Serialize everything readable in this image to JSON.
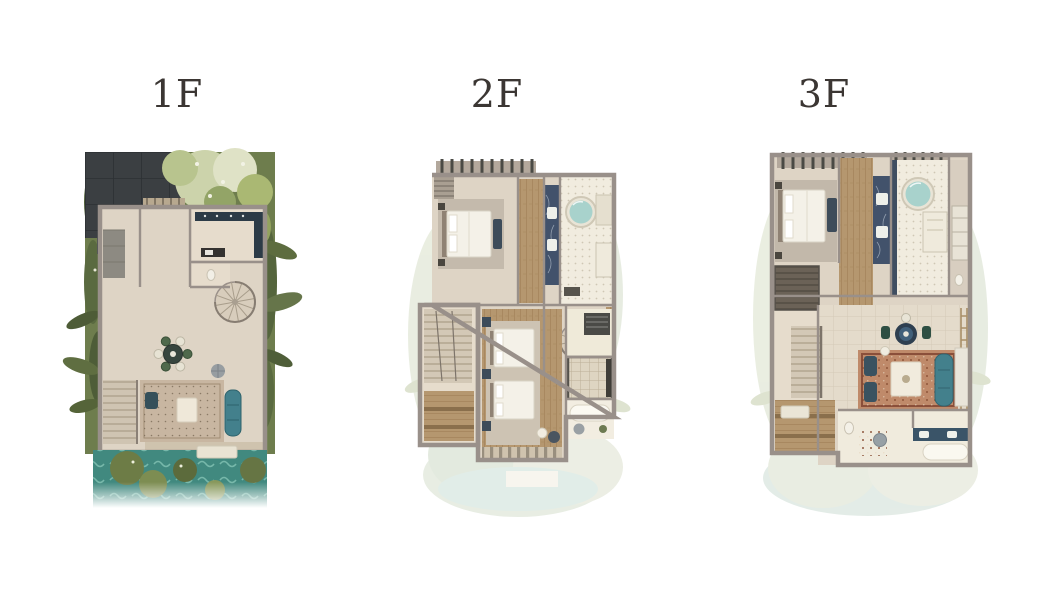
{
  "page": {
    "background": "#ffffff"
  },
  "floors": [
    {
      "label": "1F"
    },
    {
      "label": "2F"
    },
    {
      "label": "3F"
    }
  ],
  "colors": {
    "page_bg": "#ffffff",
    "label_text": "#3b3633",
    "wall": "#99908a",
    "wall_light": "#b5aba0",
    "floor_beige": "#ded4c5",
    "wood": "#b5976f",
    "pool_teal": "#41897f",
    "sofa_teal": "#43808c",
    "garden_green": "#6e7d4d",
    "driveway_dark": "#3b3f42",
    "rug_terracotta": "#bf8a6a",
    "tub_water": "#a8d2cc",
    "navy_furniture": "#3d4c5a",
    "watermark_sage": "#e6ebdc"
  }
}
